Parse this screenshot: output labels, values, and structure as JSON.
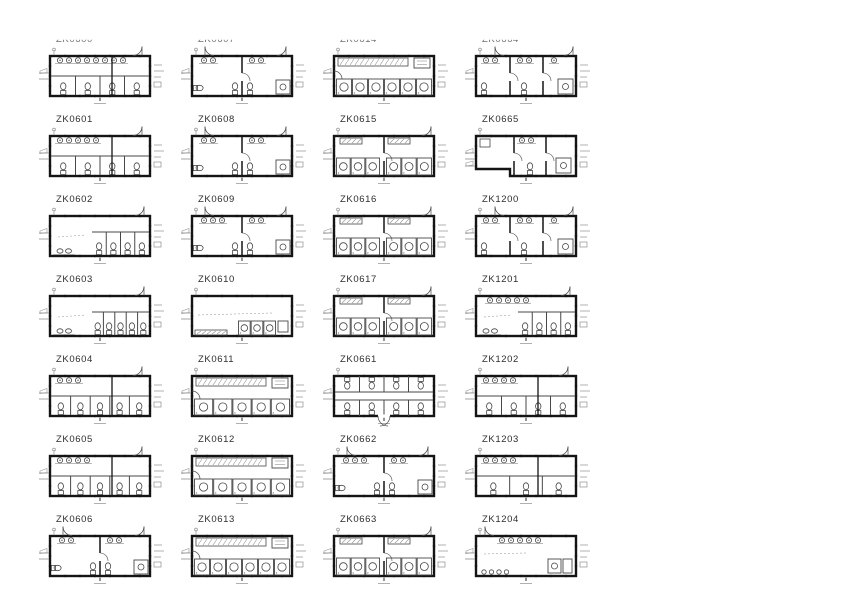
{
  "colors": {
    "background": "#ffffff",
    "ink": "#141414",
    "thin": "#474747",
    "faint": "#8f8f8f"
  },
  "plans": [
    {
      "label": "ZK0600",
      "variant": "wcrow",
      "sinks": 8,
      "stalls": 4
    },
    {
      "label": "ZK0607",
      "variant": "tworoom",
      "sinks": 2,
      "stalls": 2
    },
    {
      "label": "ZK0614",
      "variant": "showerrow",
      "stalls": 6
    },
    {
      "label": "ZK0664",
      "variant": "threeroom"
    },
    {
      "label": "ZK0601",
      "variant": "wcrow",
      "sinks": 5,
      "stalls": 4
    },
    {
      "label": "ZK0608",
      "variant": "tworoom",
      "sinks": 2,
      "stalls": 2
    },
    {
      "label": "ZK0615",
      "variant": "twoshower",
      "stalls": 3
    },
    {
      "label": "ZK0665",
      "variant": "lshape"
    },
    {
      "label": "ZK0602",
      "variant": "wcright",
      "sinks": 2,
      "stalls": 4
    },
    {
      "label": "ZK0609",
      "variant": "tworoom",
      "sinks": 3,
      "stalls": 2
    },
    {
      "label": "ZK0616",
      "variant": "twoshower",
      "stalls": 3
    },
    {
      "label": "ZK1200",
      "variant": "threeroom"
    },
    {
      "label": "ZK0603",
      "variant": "wcright",
      "sinks": 2,
      "stalls": 5
    },
    {
      "label": "ZK0610",
      "variant": "openbench",
      "stalls": 3
    },
    {
      "label": "ZK0617",
      "variant": "twoshower",
      "stalls": 3
    },
    {
      "label": "ZK1201",
      "variant": "wcright",
      "sinks": 5,
      "stalls": 4
    },
    {
      "label": "ZK0604",
      "variant": "wcrow",
      "sinks": 3,
      "stalls": 5
    },
    {
      "label": "ZK0611",
      "variant": "showerrow",
      "stalls": 5
    },
    {
      "label": "ZK0661",
      "variant": "doublerow",
      "stalls": 4
    },
    {
      "label": "ZK1202",
      "variant": "wcrow",
      "sinks": 4,
      "stalls": 4
    },
    {
      "label": "ZK0605",
      "variant": "wcrow",
      "sinks": 4,
      "stalls": 5
    },
    {
      "label": "ZK0612",
      "variant": "showerrow",
      "stalls": 5
    },
    {
      "label": "ZK0662",
      "variant": "tworoom",
      "sinks": 3,
      "stalls": 2
    },
    {
      "label": "ZK1203",
      "variant": "wcrow",
      "sinks": 4,
      "stalls": 3
    },
    {
      "label": "ZK0606",
      "variant": "tworoom",
      "sinks": 2,
      "stalls": 2
    },
    {
      "label": "ZK0613",
      "variant": "showerrow",
      "stalls": 6
    },
    {
      "label": "ZK0663",
      "variant": "twoshower",
      "stalls": 3
    },
    {
      "label": "ZK1204",
      "variant": "openmixed",
      "sinks": 5
    }
  ]
}
